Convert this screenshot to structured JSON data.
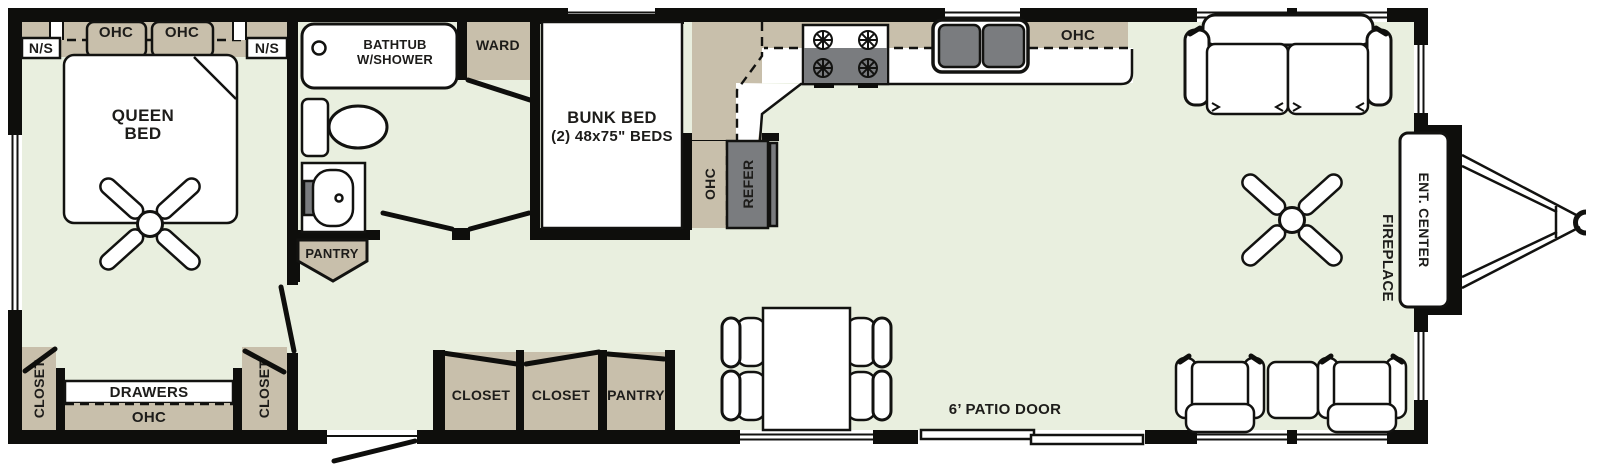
{
  "colors": {
    "floor": "#e9efdf",
    "cabinet": "#c8bfab",
    "appliance": "#7a7c7f",
    "wall": "#0e0e0c",
    "text": "#1d1c1a"
  },
  "bedroom": {
    "ohc": "OHC",
    "nightstand": "N/S",
    "bed_line1": "QUEEN",
    "bed_line2": "BED",
    "closet": "CLOSET",
    "drawers": "DRAWERS",
    "bottom_ohc": "OHC"
  },
  "bathroom": {
    "tub_line1": "BATHTUB",
    "tub_line2": "W/SHOWER",
    "pantry": "PANTRY",
    "ward": "WARD"
  },
  "bunk_room": {
    "line1": "BUNK BED",
    "line2": "(2) 48x75\" BEDS"
  },
  "kitchen": {
    "ohc": "OHC",
    "cabinet_ohc": "OHC",
    "refer": "REFER"
  },
  "hall": {
    "closet1": "CLOSET",
    "closet2": "CLOSET",
    "pantry": "PANTRY"
  },
  "living": {
    "patio_door": "6’ PATIO DOOR",
    "fireplace": "FIREPLACE",
    "ent_center": "ENT. CENTER"
  }
}
